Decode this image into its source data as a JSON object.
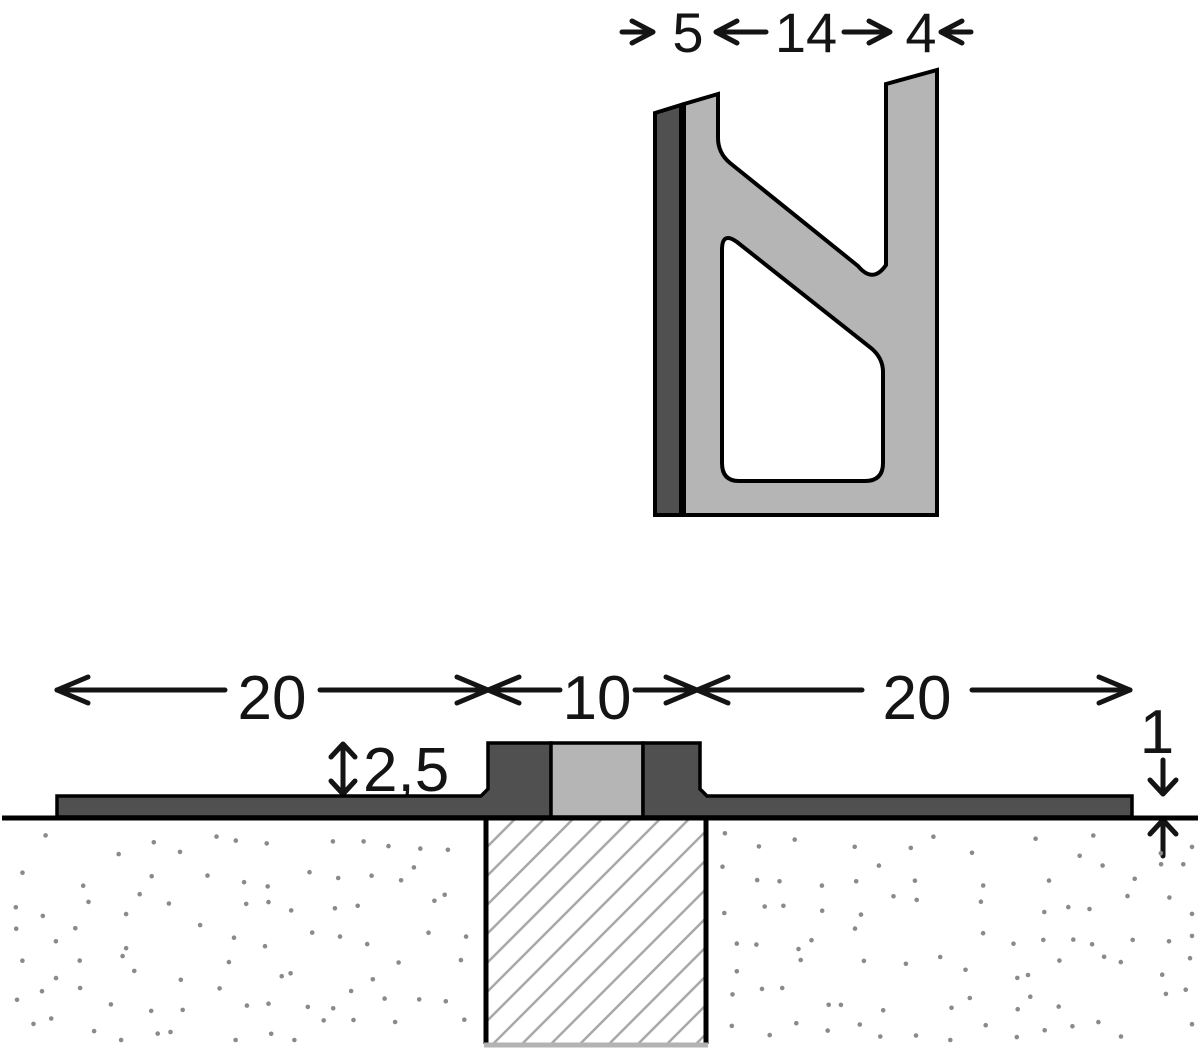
{
  "diagram": {
    "kind": "technical cross-section drawing of a movement/expansion joint floor profile",
    "views": {
      "profile_section": "enlarged N-shaped extruded profile section (top view)",
      "installed_section": "profile installed flush in floor over a hatched joint block (bottom view)"
    }
  },
  "labels": {
    "top_left": "5",
    "top_middle": "14",
    "top_right": "4",
    "bottom_left": "20",
    "bottom_center": "10",
    "bottom_right": "20",
    "height": "2,5",
    "thickness": "1"
  },
  "colors": {
    "profile_dark": "#505050",
    "profile_light": "#b5b5b5",
    "outline": "#000000",
    "dimension_ink": "#141414",
    "hatch_line": "#a8a8a8",
    "stipple_dot": "#8a8a8a",
    "background": "#ffffff"
  },
  "stipple": {
    "color": "#8a8a8a",
    "radius": 2.3,
    "cell": 31,
    "jitter": 12,
    "skip": 0.22,
    "seed": 7,
    "regions": [
      {
        "x0": 10,
        "x1": 472,
        "y0": 832,
        "y1": 1040
      },
      {
        "x0": 716,
        "x1": 1192,
        "y0": 832,
        "y1": 1040
      }
    ]
  }
}
